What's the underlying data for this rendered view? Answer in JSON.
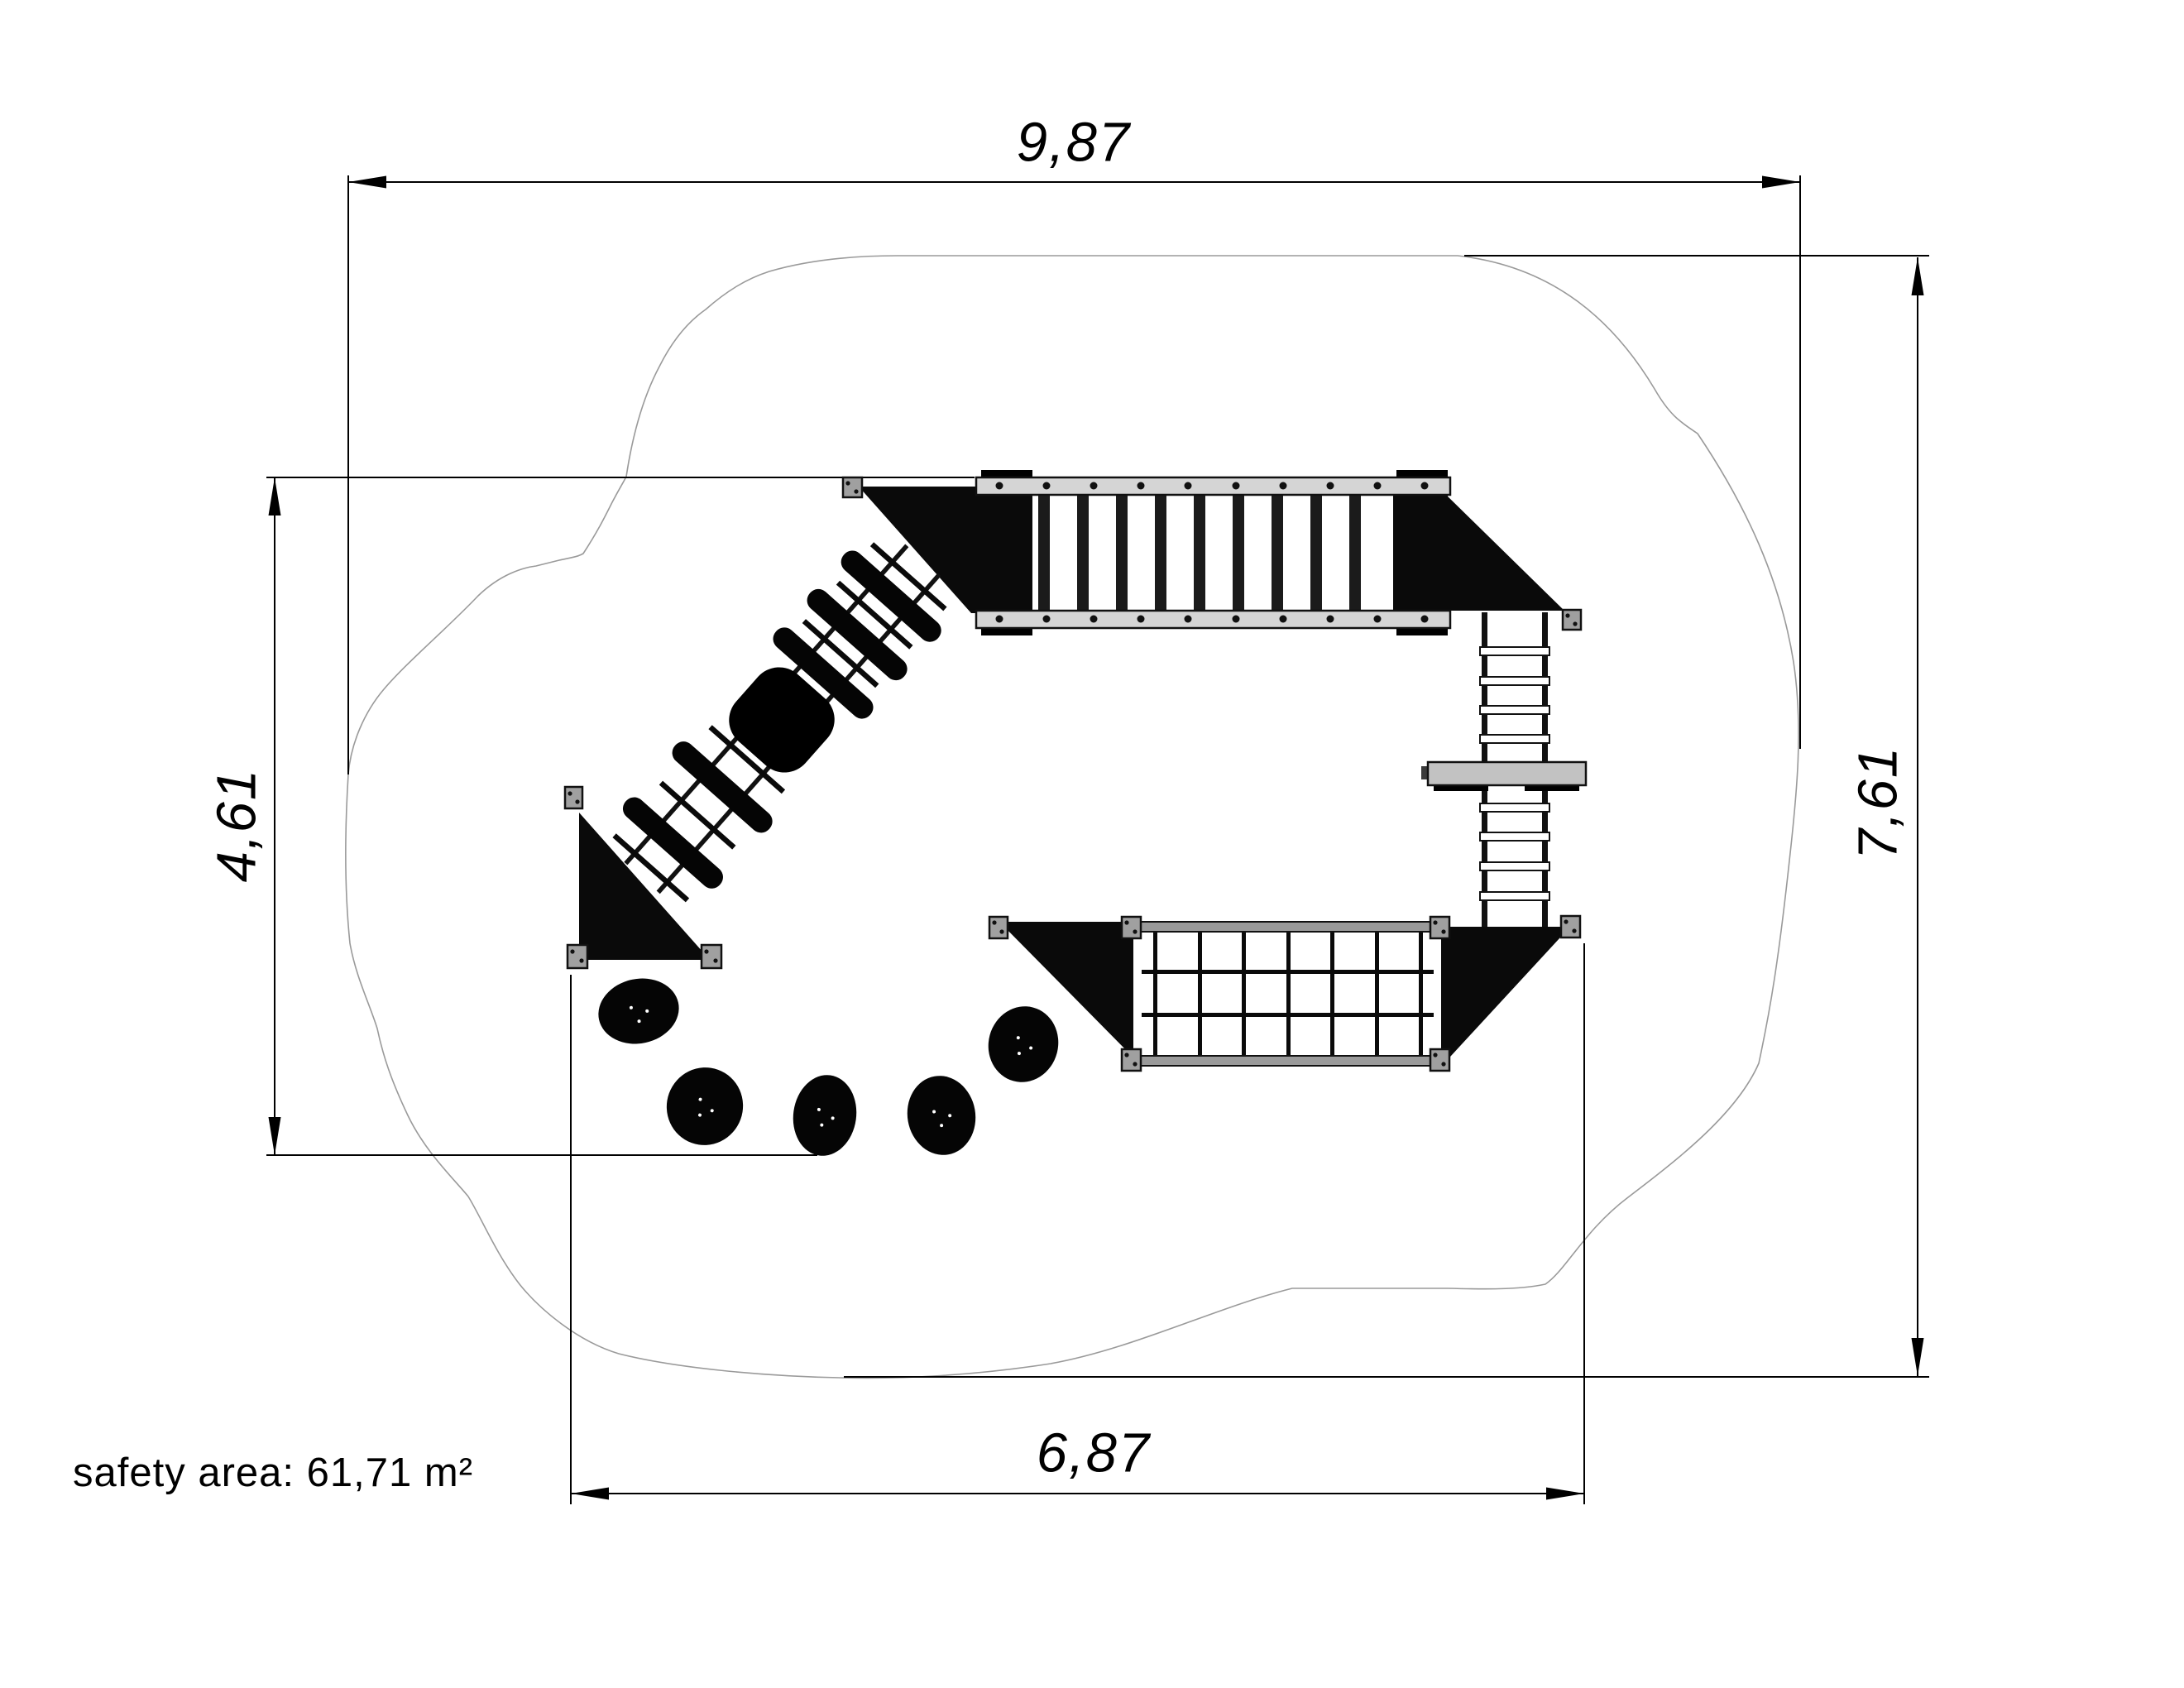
{
  "drawing": {
    "type": "playground-equipment-plan-view",
    "safety_area_label": "safety area: 61,71 m²",
    "dimensions": {
      "overall_width": "9,87",
      "overall_depth": "7,61",
      "structure_depth": "4,61",
      "structure_width": "6,87"
    },
    "parts": [
      "safety-zone-outline",
      "rung-bridge",
      "bridge-platform-triangle-left",
      "bridge-platform-triangle-right",
      "diagonal-ramp",
      "ramp-center-disc",
      "ramp-base-triangle",
      "vertical-ladder",
      "ladder-step-bar",
      "climbing-net",
      "net-platform-triangle-left",
      "net-platform-triangle-right",
      "stepping-stones"
    ],
    "counts": {
      "stepping_stones": 5,
      "bridge_rungs": 9,
      "net_columns": 6,
      "net_rows": 3,
      "ladder_rungs": 8,
      "ramp_treads": 5
    },
    "colors": {
      "background": "#ffffff",
      "line": "#000000",
      "safety_outline": "#9a9a9a",
      "rail_light": "#d5d5d5",
      "rail_mid": "#9a9a9a",
      "post_gray": "#a0a0a0",
      "step_bar": "#c2c2c2",
      "equipment_black": "#0a0a0a"
    }
  }
}
